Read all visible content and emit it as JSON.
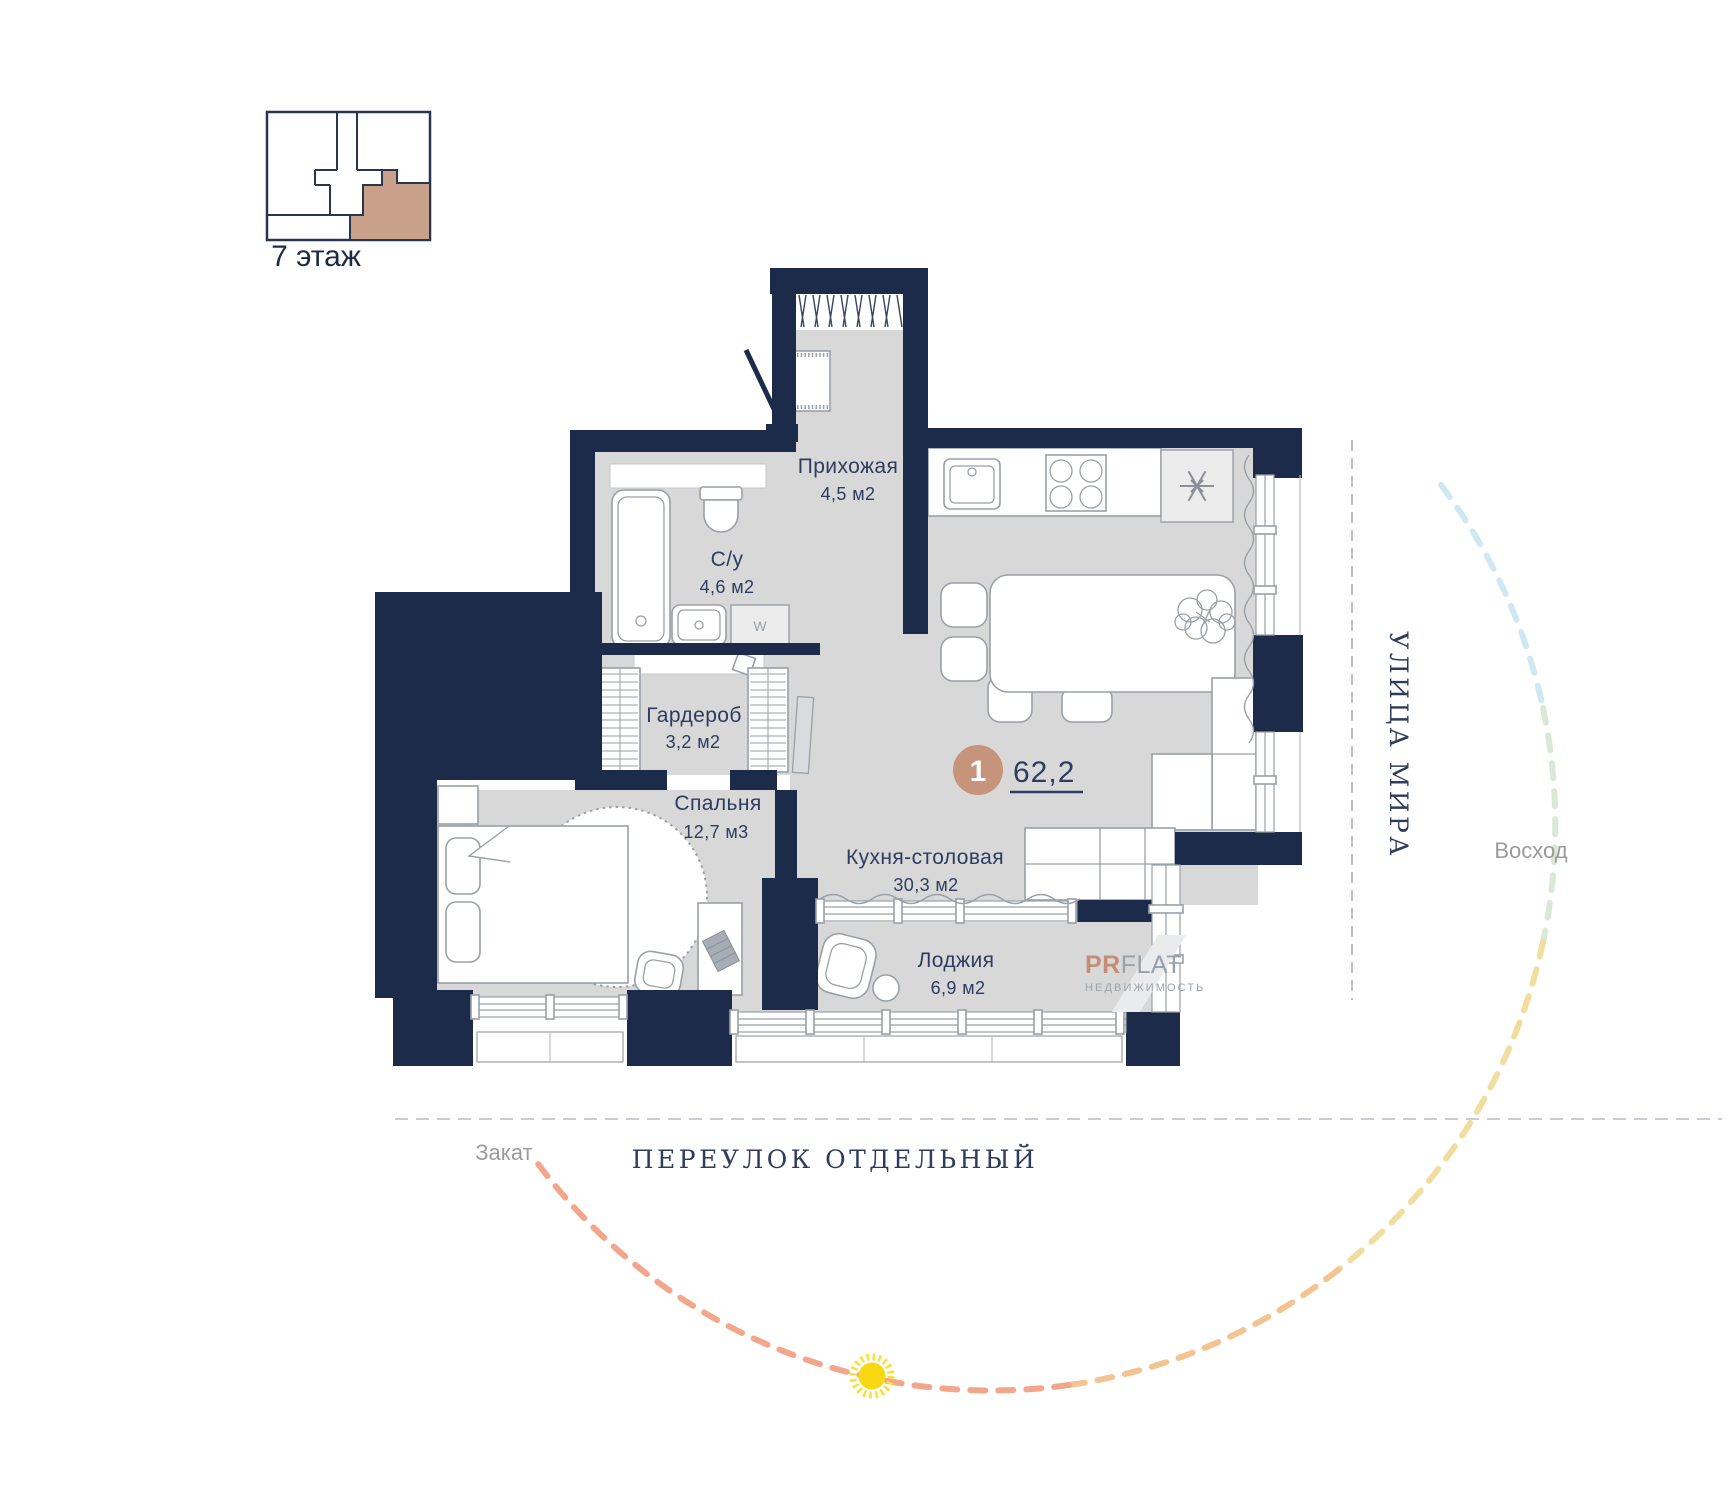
{
  "floor_indicator": {
    "label": "7 этаж",
    "highlight_color": "#c9a08a"
  },
  "unit": {
    "badge_number": "1",
    "total_area": "62,2",
    "badge_color": "#c6937b"
  },
  "rooms": [
    {
      "name": "Прихожая",
      "area": "4,5 м2"
    },
    {
      "name": "С/у",
      "area": "4,6 м2"
    },
    {
      "name": "Гардероб",
      "area": "3,2 м2"
    },
    {
      "name": "Спальня",
      "area": "12,7 м3"
    },
    {
      "name": "Кухня-столовая",
      "area": "30,3 м2"
    },
    {
      "name": "Лоджия",
      "area": "6,9 м2"
    }
  ],
  "appliances": {
    "washer_label": "W"
  },
  "streets": {
    "right_vertical": "улица Мира",
    "bottom": "переулок Отдельный"
  },
  "sun_path": {
    "sunset_label": "Закат",
    "sunrise_label": "Восход",
    "segment_colors": [
      "#cfe8f2",
      "#d9e9d4",
      "#f1dd9e",
      "#f3c492",
      "#f2a68b"
    ],
    "sun_color": "#f8d812"
  },
  "logo": {
    "prefix": "PR",
    "suffix": "FLAT",
    "subtitle": "НЕДВИЖИМОСТЬ"
  },
  "colors": {
    "wall": "#1d2b4a",
    "floor": "#d8d8d8",
    "label": "#2d3c5f",
    "muted_label": "#9b9b9b"
  }
}
